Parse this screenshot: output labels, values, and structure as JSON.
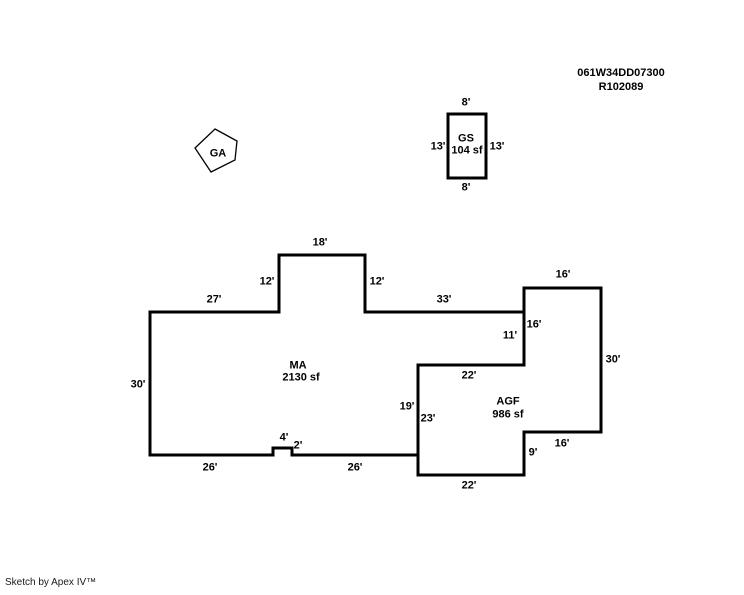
{
  "colors": {
    "background": "#FFFFFF",
    "line": "#000000",
    "text": "#000000"
  },
  "title_block": {
    "line1": "061W34DD07300",
    "line2": "R102089"
  },
  "footer": {
    "credit": "Sketch by Apex IV™"
  },
  "areas": {
    "ma": {
      "label": "MA",
      "area": "2130 sf"
    },
    "agf": {
      "label": "AGF",
      "area": "986 sf"
    },
    "gs": {
      "label": "GS",
      "area": "104 sf"
    },
    "ga": {
      "label": "GA"
    }
  },
  "dimension_labels": [
    {
      "text": "8'",
      "x": 466,
      "y": 103,
      "edge": "gs-top"
    },
    {
      "text": "13'",
      "x": 438,
      "y": 147,
      "edge": "gs-left"
    },
    {
      "text": "13'",
      "x": 497,
      "y": 147,
      "edge": "gs-right"
    },
    {
      "text": "8'",
      "x": 466,
      "y": 188,
      "edge": "gs-bottom"
    },
    {
      "text": "18'",
      "x": 320,
      "y": 243,
      "edge": "ma-bump-top"
    },
    {
      "text": "12'",
      "x": 267,
      "y": 282,
      "edge": "ma-bump-left"
    },
    {
      "text": "12'",
      "x": 377,
      "y": 282,
      "edge": "ma-bump-right"
    },
    {
      "text": "27'",
      "x": 214,
      "y": 300,
      "edge": "ma-top-left"
    },
    {
      "text": "33'",
      "x": 444,
      "y": 300,
      "edge": "ma-top-right"
    },
    {
      "text": "16'",
      "x": 563,
      "y": 275,
      "edge": "agf-top"
    },
    {
      "text": "16'",
      "x": 534,
      "y": 325,
      "edge": "agf-left-upper"
    },
    {
      "text": "11'",
      "x": 510,
      "y": 336,
      "edge": "ma-right"
    },
    {
      "text": "30'",
      "x": 613,
      "y": 360,
      "edge": "agf-right"
    },
    {
      "text": "22'",
      "x": 469,
      "y": 376,
      "edge": "agf-top-inner"
    },
    {
      "text": "19'",
      "x": 407,
      "y": 407,
      "edge": "ma-lower-right"
    },
    {
      "text": "23'",
      "x": 428,
      "y": 419,
      "edge": "agf-left-lower"
    },
    {
      "text": "30'",
      "x": 138,
      "y": 385,
      "edge": "ma-left"
    },
    {
      "text": "4'",
      "x": 284,
      "y": 438,
      "edge": "ma-notch-top"
    },
    {
      "text": "2'",
      "x": 298,
      "y": 446,
      "edge": "ma-notch-side"
    },
    {
      "text": "26'",
      "x": 210,
      "y": 468,
      "edge": "ma-bottom-left"
    },
    {
      "text": "26'",
      "x": 355,
      "y": 468,
      "edge": "ma-bottom-right"
    },
    {
      "text": "16'",
      "x": 562,
      "y": 444,
      "edge": "agf-bottom-step"
    },
    {
      "text": "9'",
      "x": 533,
      "y": 453,
      "edge": "agf-step-side"
    },
    {
      "text": "22'",
      "x": 469,
      "y": 486,
      "edge": "agf-bottom"
    }
  ],
  "shapes": {
    "ma_path": "M 150 312 H 279 V 255 H 365 V 312 H 524 V 365 H 418 V 455 H 292 V 448 H 273 V 455 H 150 Z",
    "agf_path": "M 524 288 H 601 V 432 H 524 V 475 H 418 V 365 H 524 Z",
    "gs_path": "M 448 114 H 486 V 178 H 448 Z",
    "ga_points": "215,129 237,141 235,160 211,172 195,148"
  }
}
